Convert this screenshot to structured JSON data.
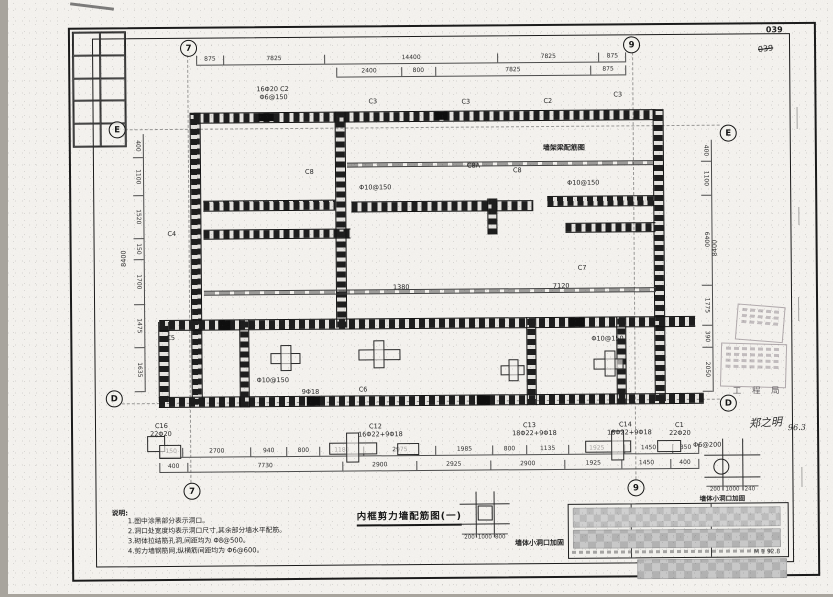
{
  "page": {
    "sheet_no": "039",
    "sheet_no_crossed": "039"
  },
  "titles": {
    "main": "内框剪力墙配筋图(一)",
    "beam_detail": "墙架梁配筋图",
    "opening_detail": "墙体小洞口加固",
    "scale_mark": "M 1 92.8"
  },
  "axes": {
    "grid_7": "7",
    "grid_9": "9",
    "grid_E": "E",
    "grid_D": "D"
  },
  "notes": {
    "heading": "说明:",
    "items": [
      "1.图中涂黑部分表示洞口。",
      "2.洞口处宽度均表示洞口尺寸,其余部分墙水平配筋。",
      "3.砌体拉结筋孔洞,间距均为 Φ8@500。",
      "4.剪力墙钢筋网,纵横筋间距均为 Φ6@600。"
    ]
  },
  "stamps": {
    "bureau": "工 程 局",
    "signature": "郑之明",
    "date": "96.3"
  },
  "dimensions": {
    "top_row1": [
      "875",
      "7825",
      "14400",
      "7825",
      "875"
    ],
    "top_row2": [
      "2400",
      "800",
      "7825",
      "875"
    ],
    "bottom_row1": [
      "150",
      "2700",
      "940",
      "800",
      "1180",
      "2975",
      "1985",
      "800",
      "1135",
      "1925",
      "1450",
      "350"
    ],
    "bottom_row2": [
      "400",
      "7730",
      "2900",
      "2925",
      "2900",
      "1925",
      "1450",
      "400"
    ],
    "left_col": [
      "400",
      "1100",
      "1520",
      "150",
      "1700",
      "1475",
      "1635"
    ],
    "right_col": [
      "400",
      "1100",
      "6400",
      "1775",
      "390",
      "2050"
    ],
    "left_total": "8400",
    "right_total": "8400",
    "detail_center": [
      "200",
      "1000",
      "800"
    ],
    "detail_right": [
      "200",
      "1000",
      "240"
    ]
  },
  "plan_labels": [
    "16Φ20 C2",
    "Φ6@150",
    "C3",
    "C3",
    "C2",
    "C3",
    "C8",
    "C8A",
    "C8",
    "C4",
    "C5",
    "Φ10@150",
    "Φ10@150",
    "1380",
    "7120",
    "Φ10@150",
    "Φ10@150",
    "9Φ18",
    "C16",
    "22Φ20",
    "C12",
    "16Φ22+9Φ18",
    "C13",
    "18Φ22+9Φ18",
    "C14",
    "18Φ22+9Φ18",
    "C1",
    "22Φ20",
    "Φ6@200",
    "C7",
    "C6"
  ]
}
